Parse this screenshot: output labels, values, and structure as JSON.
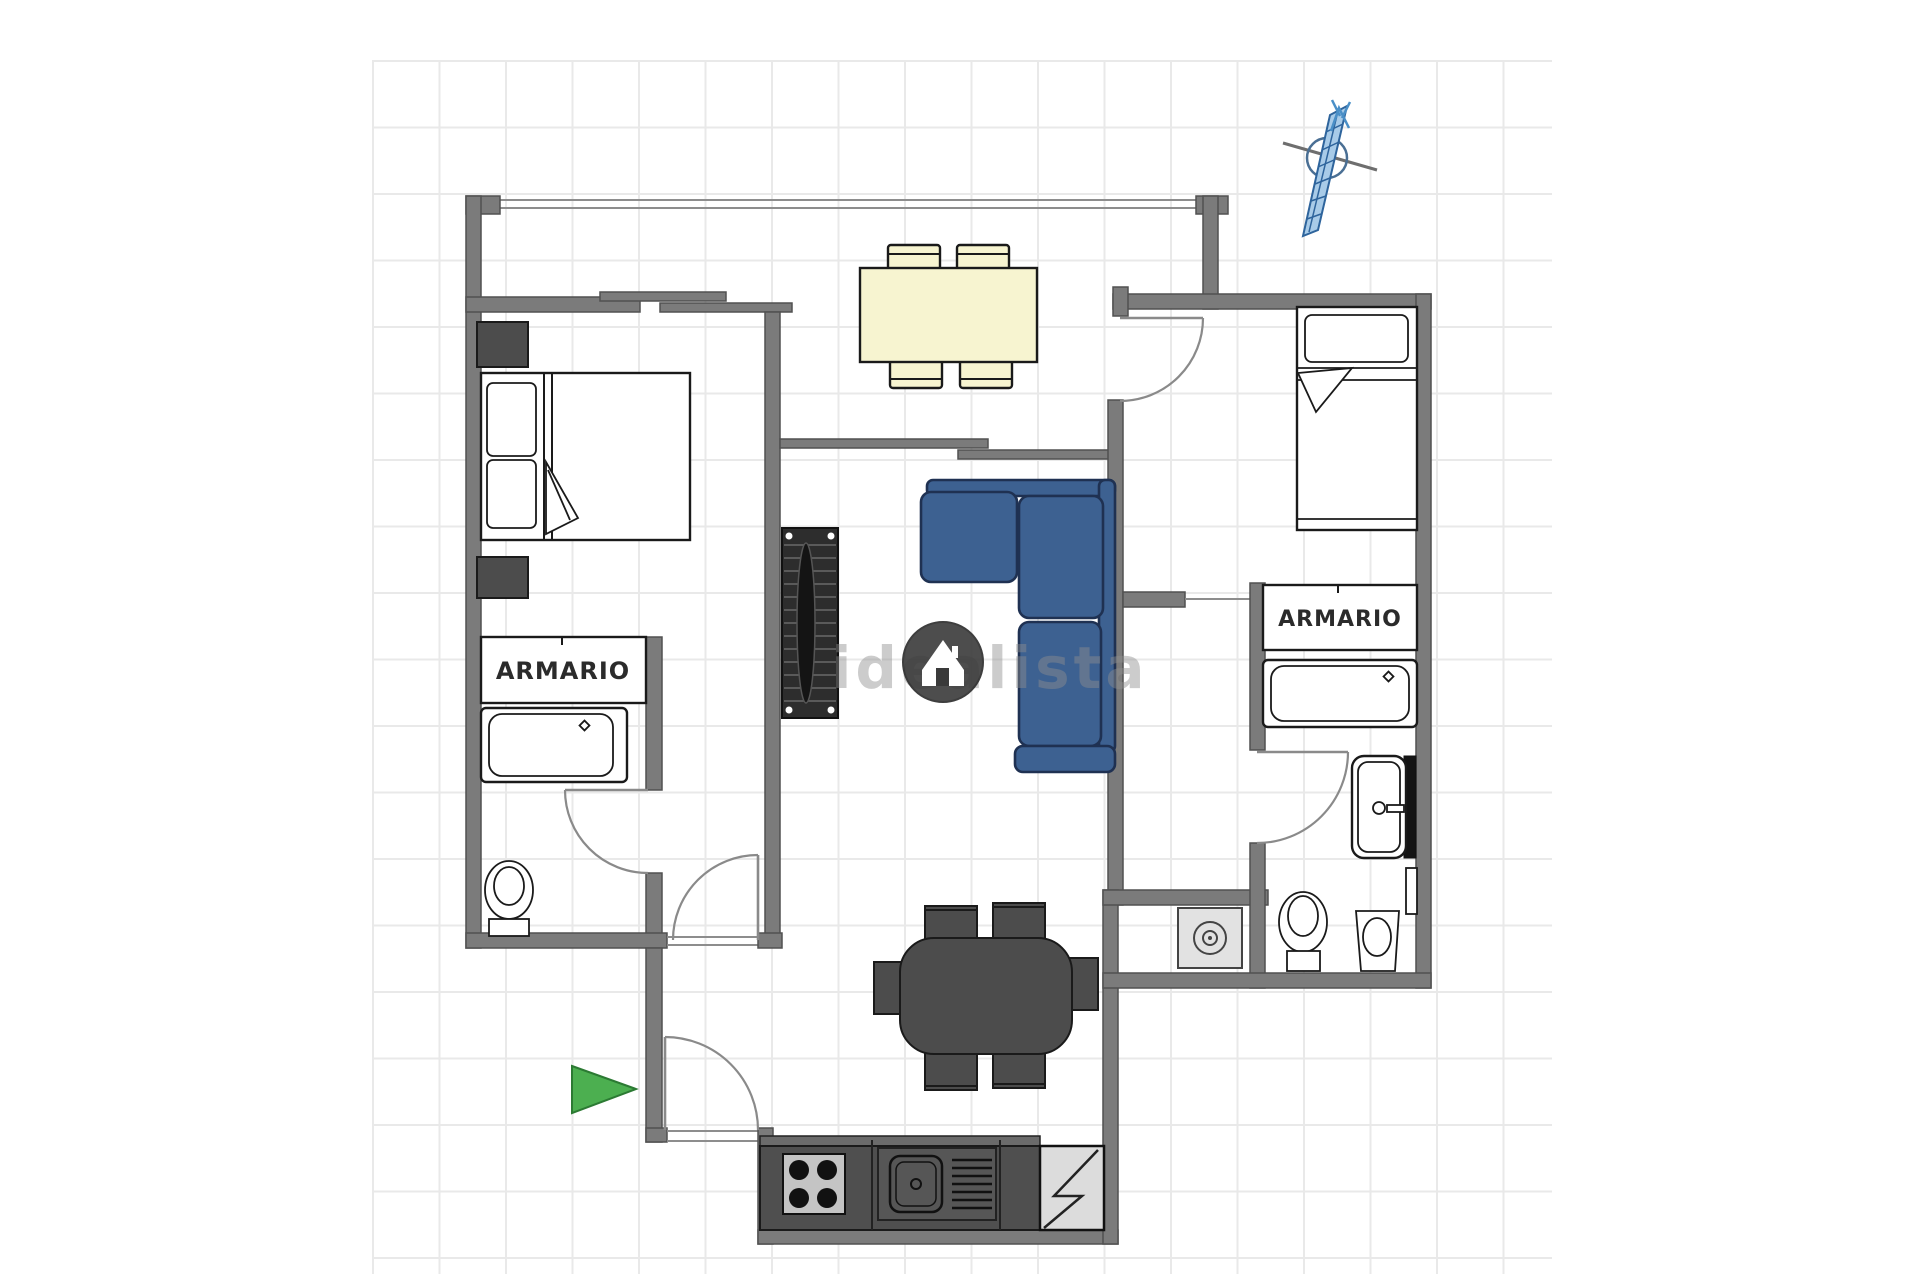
{
  "page": {
    "kind": "real-estate floor plan image",
    "background": "#ffffff"
  },
  "floor_plan": {
    "labels": {
      "closet_left": "ARMARIO",
      "closet_right": "ARMARIO"
    },
    "watermark": {
      "text": "idealista",
      "logo": "idealista-house-logo"
    },
    "indicators": [
      "north-compass-arrow",
      "entrance-direction-arrow"
    ],
    "furniture_icons": [
      "double-bed",
      "nightstand",
      "nightstand",
      "single-bed",
      "terrace-dining-table-4-chairs",
      "l-shaped-sofa",
      "radiator-sideboard",
      "kitchen-table-6-chairs",
      "kitchen-counter",
      "stove-4-burners",
      "kitchen-sink-with-drainer",
      "refrigerator",
      "washing-machine",
      "bathtub-left",
      "toilet-left",
      "bathtub-right",
      "washbasin",
      "toilet-right",
      "bidet",
      "wall-shelf-mirror"
    ]
  },
  "colors": {
    "wall": "#7b7b7b",
    "wall-stroke": "#515151",
    "line": "#8d8d8d",
    "ink": "#1a1a1a",
    "sofa": "#3d6191",
    "sofa-dark": "#1f3152",
    "cream": "#f7f4d0",
    "dark-furn": "#4c4c4c",
    "radiator": "#2d2d2d",
    "plate": "#c4c4c4",
    "washer": "#e2e2e2",
    "green": "#4caf50",
    "green-dark": "#2c7a33",
    "compass": "#4a8fc7",
    "compass-dark": "#2e649c",
    "cross": "#6e6e6e",
    "grid": "#e9e9e9",
    "wm": "#8f8f8f",
    "wm-logo": "#3a3a3a"
  }
}
